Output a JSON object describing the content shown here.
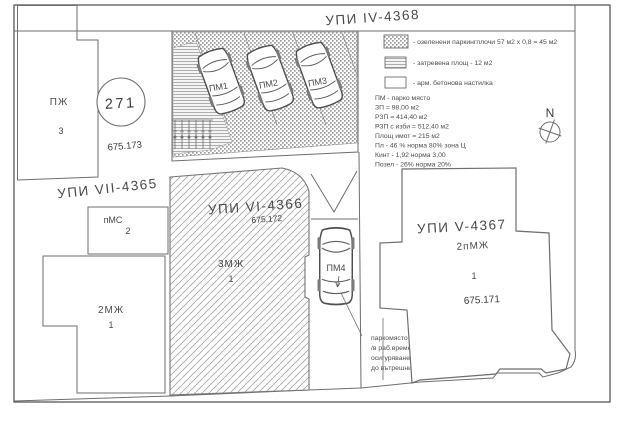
{
  "plan": {
    "parcels": {
      "iv_label": "УПИ IV-4368",
      "vii_label": "УПИ VII-4365",
      "vi_label": "УПИ VI-4366",
      "vi_elevation": "675.172",
      "v_label": "УПИ V-4367",
      "v_type": "2пМЖ",
      "v_no": "1",
      "v_elevation": "675.171"
    },
    "buildings": {
      "pj_label": "ПЖ",
      "pj_no": "3",
      "pms_label": "пМС",
      "pms_no": "2",
      "mj2_label": "2МЖ",
      "mj2_no": "1",
      "mj3_label": "3МЖ",
      "mj3_no": "1"
    },
    "survey_point": {
      "number": "271",
      "elevation": "675.173"
    },
    "parking_spots": [
      "ПМ1",
      "ПМ2",
      "ПМ3",
      "ПМ4"
    ],
    "legend": [
      {
        "pattern": "dots",
        "label": "- озеленени паркингплочи 57 м2 х 0,8 = 45 м2"
      },
      {
        "pattern": "grass",
        "label": "- затревена площ - 12 м2"
      },
      {
        "pattern": "plain",
        "label": "- арм. бетонова настилка"
      }
    ],
    "stats": [
      "ПМ - парко място",
      "ЗП = 98,00 м2",
      "РЗП =  414,40 м2",
      "РЗП с изби =  512,40 м2",
      "Площ имот =  215 м2",
      "Пл  - 46 %    норма 80% зона Ц",
      "Кинт - 1,92   норма 3,00",
      "Позел - 26% норма 20%"
    ],
    "note_lines": [
      "паркомясто за офис",
      "/в раб.време и",
      "осигуряване достъп",
      "до вътрешни паркоместа/"
    ],
    "compass_label": "N",
    "colors": {
      "line": "#6e6e6e",
      "texture": "#9e9e9e",
      "text": "#3d3d3d"
    }
  }
}
